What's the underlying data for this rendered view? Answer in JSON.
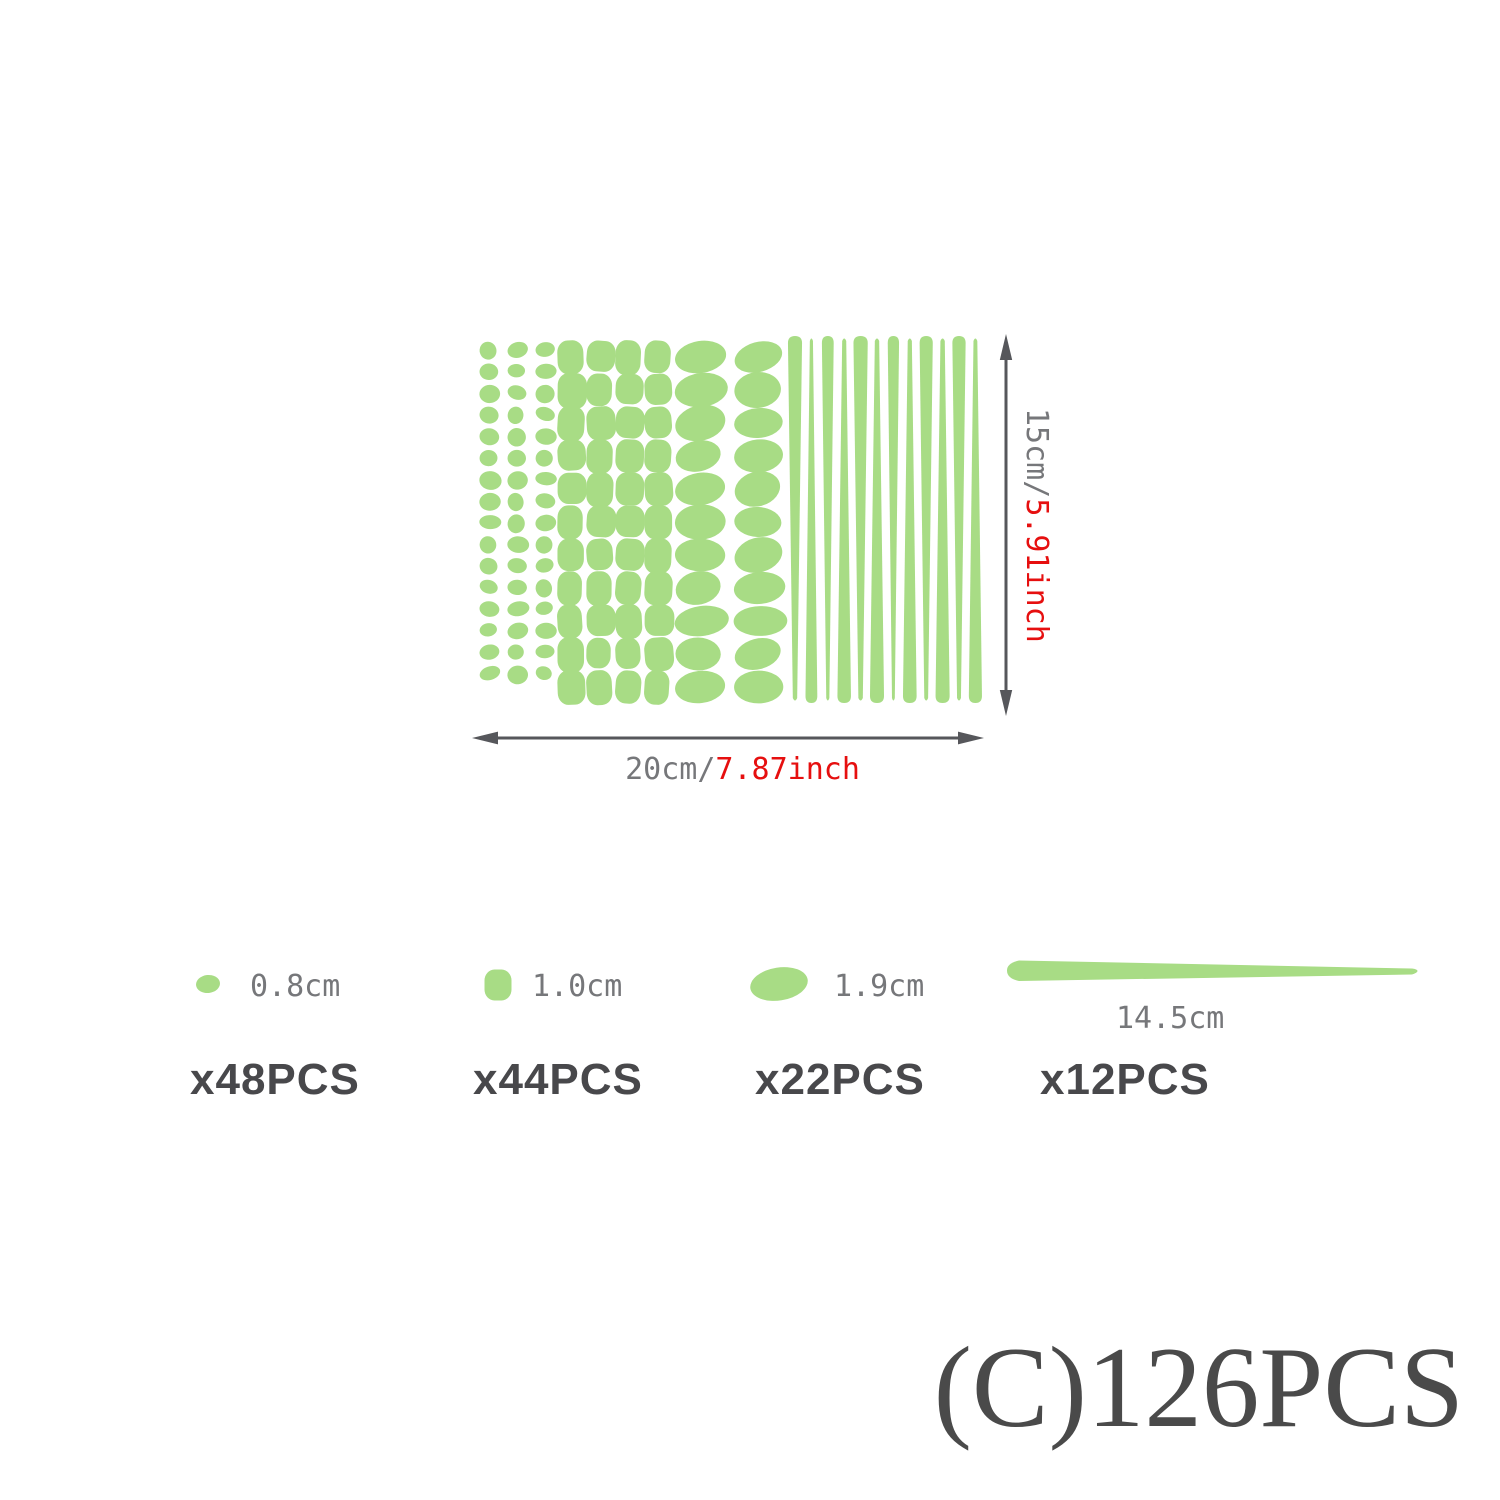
{
  "colors": {
    "green": "#a8dc85",
    "label_gray": "#76777a",
    "arrow_gray": "#56575b",
    "accent_red": "#e60f0f",
    "count_dark": "#48484b",
    "total_dark": "#4a4a4a"
  },
  "diagram": {
    "height_label": {
      "metric": "15cm/",
      "imperial": "5.91inch"
    },
    "width_label": {
      "metric": "20cm/",
      "imperial": "7.87inch"
    },
    "sheet": {
      "dot_grid": {
        "shape": "dot",
        "rows": 16,
        "cols": 3,
        "count": 48
      },
      "square_grid": {
        "shape": "rounded-square",
        "rows": 11,
        "cols": 4,
        "count": 44
      },
      "oval_grid": {
        "shape": "oval",
        "rows": 11,
        "cols": 2,
        "count": 22
      },
      "line_strip": {
        "shape": "tapered-line",
        "count": 12
      }
    }
  },
  "legend": [
    {
      "shape": "dot",
      "size": "0.8cm",
      "count": "x48PCS"
    },
    {
      "shape": "rounded-square",
      "size": "1.0cm",
      "count": "x44PCS"
    },
    {
      "shape": "oval",
      "size": "1.9cm",
      "count": "x22PCS"
    },
    {
      "shape": "tapered-line",
      "size": "14.5cm",
      "count": "x12PCS"
    }
  ],
  "total_label": "(C)126PCS"
}
